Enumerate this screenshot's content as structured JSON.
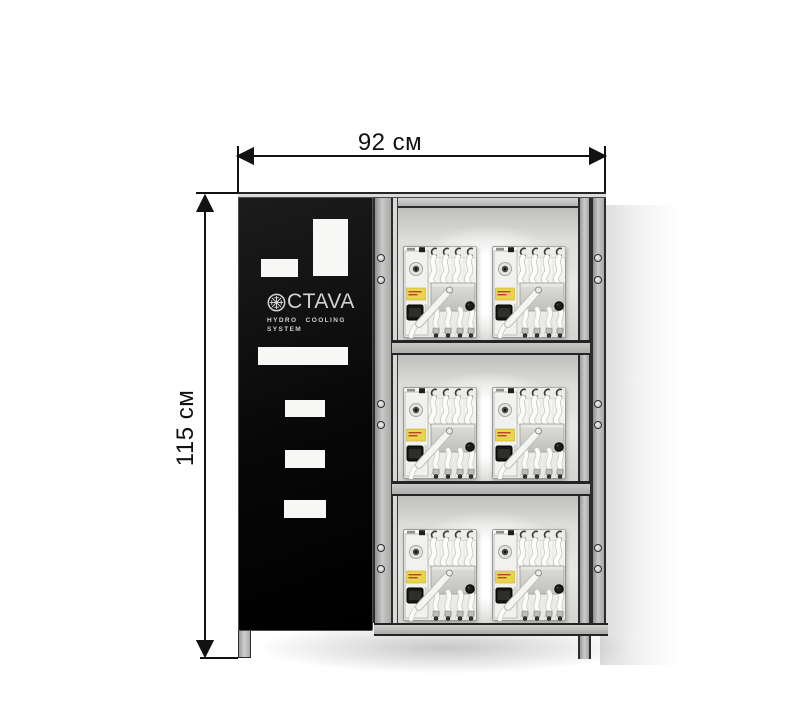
{
  "dimensions": {
    "width_label": "92 см",
    "height_label": "115 см"
  },
  "branding": {
    "logo_text": "CTAVA",
    "tagline_line1": "HYDRO COOLING",
    "tagline_line2": "SYSTEM"
  },
  "equipment": {
    "shelf_count": 3,
    "units_per_shelf": 2
  },
  "colors": {
    "door_black": "#0a0a0a",
    "frame_gray": "#bdbdbd",
    "frame_outline": "#2c2c2c",
    "vent_white": "#f7f7f6",
    "unit_label_yellow": "#e9d44e",
    "dimension_line": "#121212",
    "logo_gray": "#d2d2d0"
  }
}
